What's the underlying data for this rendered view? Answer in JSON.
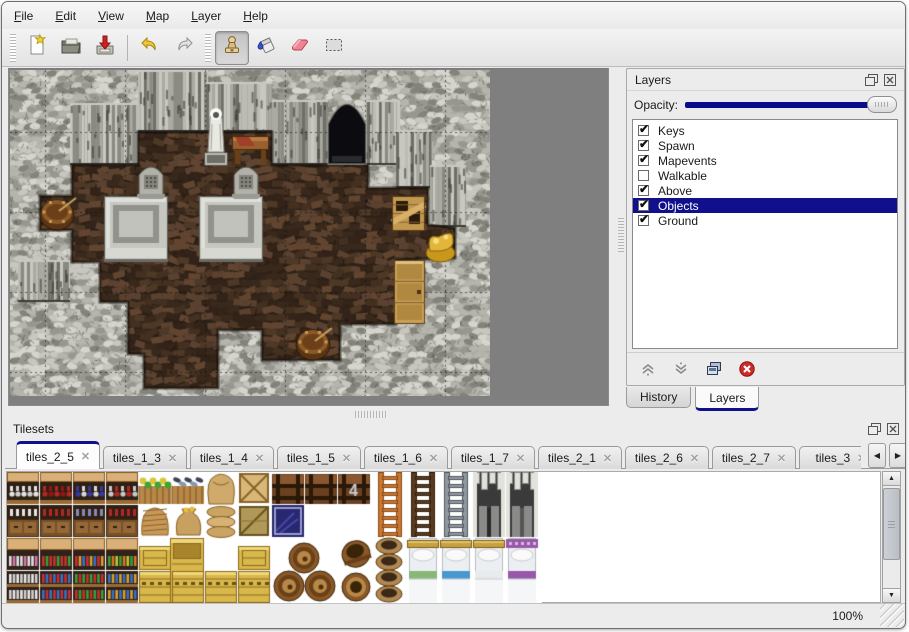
{
  "accent": "#10108c",
  "menubar": {
    "items": [
      {
        "label": "File"
      },
      {
        "label": "Edit"
      },
      {
        "label": "View"
      },
      {
        "label": "Map"
      },
      {
        "label": "Layer"
      },
      {
        "label": "Help"
      }
    ]
  },
  "toolbar": {
    "buttons": [
      "new",
      "open",
      "save",
      "undo",
      "redo",
      "stamp",
      "fill",
      "eraser",
      "select"
    ],
    "active_tool": "stamp"
  },
  "layers_panel": {
    "title": "Layers",
    "opacity_label": "Opacity:",
    "opacity_value_pct": 100,
    "layers": [
      {
        "name": "Keys",
        "checked": true,
        "selected": false
      },
      {
        "name": "Spawn",
        "checked": true,
        "selected": false
      },
      {
        "name": "Mapevents",
        "checked": true,
        "selected": false
      },
      {
        "name": "Walkable",
        "checked": false,
        "selected": false
      },
      {
        "name": "Above",
        "checked": true,
        "selected": false
      },
      {
        "name": "Objects",
        "checked": true,
        "selected": true
      },
      {
        "name": "Ground",
        "checked": true,
        "selected": false
      }
    ],
    "buttons": [
      "move-layer-up",
      "move-layer-down",
      "duplicate-layer",
      "delete-layer"
    ],
    "tabs": [
      {
        "label": "History",
        "active": false
      },
      {
        "label": "Layers",
        "active": true
      }
    ]
  },
  "tilesets_panel": {
    "title": "Tilesets",
    "tabs": [
      {
        "label": "tiles_2_5",
        "active": true
      },
      {
        "label": "tiles_1_3",
        "active": false
      },
      {
        "label": "tiles_1_4",
        "active": false
      },
      {
        "label": "tiles_1_5",
        "active": false
      },
      {
        "label": "tiles_1_6",
        "active": false
      },
      {
        "label": "tiles_1_7",
        "active": false
      },
      {
        "label": "tiles_2_1",
        "active": false
      },
      {
        "label": "tiles_2_6",
        "active": false
      },
      {
        "label": "tiles_2_7",
        "active": false
      },
      {
        "label": "tiles_3",
        "active": false
      }
    ]
  },
  "statusbar": {
    "zoom": "100%"
  },
  "map": {
    "grid": {
      "spacing": 80,
      "offset_x": 35,
      "offset_y": 62
    },
    "floor_polygon": [
      [
        62,
        95
      ],
      [
        128,
        95
      ],
      [
        128,
        62
      ],
      [
        262,
        62
      ],
      [
        262,
        95
      ],
      [
        318,
        95
      ],
      [
        354,
        95
      ],
      [
        358,
        95
      ],
      [
        358,
        118
      ],
      [
        418,
        118
      ],
      [
        418,
        155
      ],
      [
        445,
        158
      ],
      [
        445,
        188
      ],
      [
        386,
        190
      ],
      [
        386,
        254
      ],
      [
        330,
        254
      ],
      [
        330,
        290
      ],
      [
        252,
        290
      ],
      [
        252,
        260
      ],
      [
        208,
        260
      ],
      [
        208,
        318
      ],
      [
        134,
        318
      ],
      [
        134,
        284
      ],
      [
        118,
        284
      ],
      [
        118,
        232
      ],
      [
        90,
        232
      ],
      [
        90,
        192
      ],
      [
        62,
        192
      ],
      [
        62,
        160
      ],
      [
        30,
        160
      ],
      [
        30,
        126
      ],
      [
        62,
        126
      ]
    ],
    "cliffs": [
      [
        60,
        33,
        70,
        62
      ],
      [
        128,
        0,
        70,
        62
      ],
      [
        196,
        12,
        66,
        50
      ],
      [
        262,
        30,
        56,
        65
      ],
      [
        354,
        30,
        36,
        65
      ],
      [
        386,
        60,
        36,
        58
      ],
      [
        420,
        95,
        36,
        62
      ],
      [
        8,
        190,
        52,
        42
      ]
    ],
    "objects": [
      {
        "type": "doorway",
        "x": 318,
        "y": 28,
        "w": 38,
        "h": 66
      },
      {
        "type": "platform",
        "x": 94,
        "y": 126,
        "w": 64,
        "h": 66
      },
      {
        "type": "platform",
        "x": 189,
        "y": 126,
        "w": 64,
        "h": 66
      },
      {
        "type": "tombstone",
        "x": 126,
        "y": 95,
        "w": 30,
        "h": 33
      },
      {
        "type": "tombstone",
        "x": 221,
        "y": 95,
        "w": 30,
        "h": 33
      },
      {
        "type": "statue",
        "x": 190,
        "y": 30,
        "w": 32,
        "h": 68
      },
      {
        "type": "table",
        "x": 222,
        "y": 62,
        "w": 37,
        "h": 34
      },
      {
        "type": "barrel_stuff",
        "x": 30,
        "y": 126,
        "w": 34,
        "h": 34
      },
      {
        "type": "barrel_stuff",
        "x": 286,
        "y": 256,
        "w": 34,
        "h": 34
      },
      {
        "type": "crate_broken",
        "x": 382,
        "y": 126,
        "w": 33,
        "h": 35
      },
      {
        "type": "gold",
        "x": 414,
        "y": 157,
        "w": 33,
        "h": 34
      },
      {
        "type": "cabinet",
        "x": 384,
        "y": 190,
        "w": 31,
        "h": 64
      }
    ]
  },
  "tileset_tiles": [
    {
      "t": "shelfA",
      "x": 0,
      "y": 0,
      "v": 0
    },
    {
      "t": "shelfA",
      "x": 33,
      "y": 0,
      "v": 1
    },
    {
      "t": "shelfA",
      "x": 66,
      "y": 0,
      "v": 2
    },
    {
      "t": "shelfA",
      "x": 99,
      "y": 0,
      "v": 3
    },
    {
      "t": "vegcrate",
      "x": 132,
      "y": 0
    },
    {
      "t": "fishcrate",
      "x": 165,
      "y": 0
    },
    {
      "t": "sacktop",
      "x": 198,
      "y": 0
    },
    {
      "t": "cratex",
      "x": 231,
      "y": 0
    },
    {
      "t": "chest",
      "x": 265,
      "y": 0,
      "v": 0
    },
    {
      "t": "chest",
      "x": 298,
      "y": 0,
      "v": 0
    },
    {
      "t": "chest",
      "x": 331,
      "y": 0,
      "v": 1
    },
    {
      "t": "shelfAb",
      "x": 0,
      "y": 33,
      "v": 0
    },
    {
      "t": "shelfAb",
      "x": 33,
      "y": 33,
      "v": 1
    },
    {
      "t": "shelfAb",
      "x": 66,
      "y": 33,
      "v": 2
    },
    {
      "t": "shelfAb",
      "x": 99,
      "y": 33,
      "v": 3
    },
    {
      "t": "wovensack",
      "x": 132,
      "y": 33
    },
    {
      "t": "moneybag",
      "x": 165,
      "y": 33
    },
    {
      "t": "sackpile",
      "x": 198,
      "y": 33
    },
    {
      "t": "cratedark",
      "x": 231,
      "y": 33
    },
    {
      "t": "bluecrate",
      "x": 265,
      "y": 33
    },
    {
      "t": "ladder",
      "x": 367,
      "y": 0,
      "v": 0
    },
    {
      "t": "ladder",
      "x": 400,
      "y": 0,
      "v": 1
    },
    {
      "t": "ladder",
      "x": 433,
      "y": 0,
      "v": 2
    },
    {
      "t": "arch",
      "x": 466,
      "y": 0,
      "v": 0
    },
    {
      "t": "arch",
      "x": 499,
      "y": 0,
      "v": 1
    },
    {
      "t": "shelfB",
      "x": 0,
      "y": 66,
      "v": 0
    },
    {
      "t": "shelfB",
      "x": 33,
      "y": 66,
      "v": 1
    },
    {
      "t": "shelfB",
      "x": 66,
      "y": 66,
      "v": 2
    },
    {
      "t": "shelfB",
      "x": 99,
      "y": 66,
      "v": 3
    },
    {
      "t": "shelfBb",
      "x": 0,
      "y": 99,
      "v": 0
    },
    {
      "t": "shelfBb",
      "x": 33,
      "y": 99,
      "v": 1
    },
    {
      "t": "shelfBb",
      "x": 66,
      "y": 99,
      "v": 2
    },
    {
      "t": "shelfBb",
      "x": 99,
      "y": 99,
      "v": 3
    },
    {
      "t": "ylid",
      "x": 132,
      "y": 74
    },
    {
      "t": "ybig",
      "x": 163,
      "y": 66
    },
    {
      "t": "ylid",
      "x": 231,
      "y": 74
    },
    {
      "t": "yfront",
      "x": 132,
      "y": 99
    },
    {
      "t": "yfront",
      "x": 165,
      "y": 99
    },
    {
      "t": "yfront",
      "x": 198,
      "y": 99
    },
    {
      "t": "yfront",
      "x": 231,
      "y": 99
    },
    {
      "t": "barrelpile",
      "x": 265,
      "y": 66
    },
    {
      "t": "barreltilt",
      "x": 333,
      "y": 66
    },
    {
      "t": "barrelup",
      "x": 333,
      "y": 99
    },
    {
      "t": "pots",
      "x": 366,
      "y": 66
    },
    {
      "t": "bed",
      "x": 400,
      "y": 66,
      "v": "green"
    },
    {
      "t": "bed",
      "x": 433,
      "y": 66,
      "v": "blue"
    },
    {
      "t": "bed",
      "x": 466,
      "y": 66,
      "v": "white"
    },
    {
      "t": "bed",
      "x": 499,
      "y": 66,
      "v": "purple"
    }
  ]
}
